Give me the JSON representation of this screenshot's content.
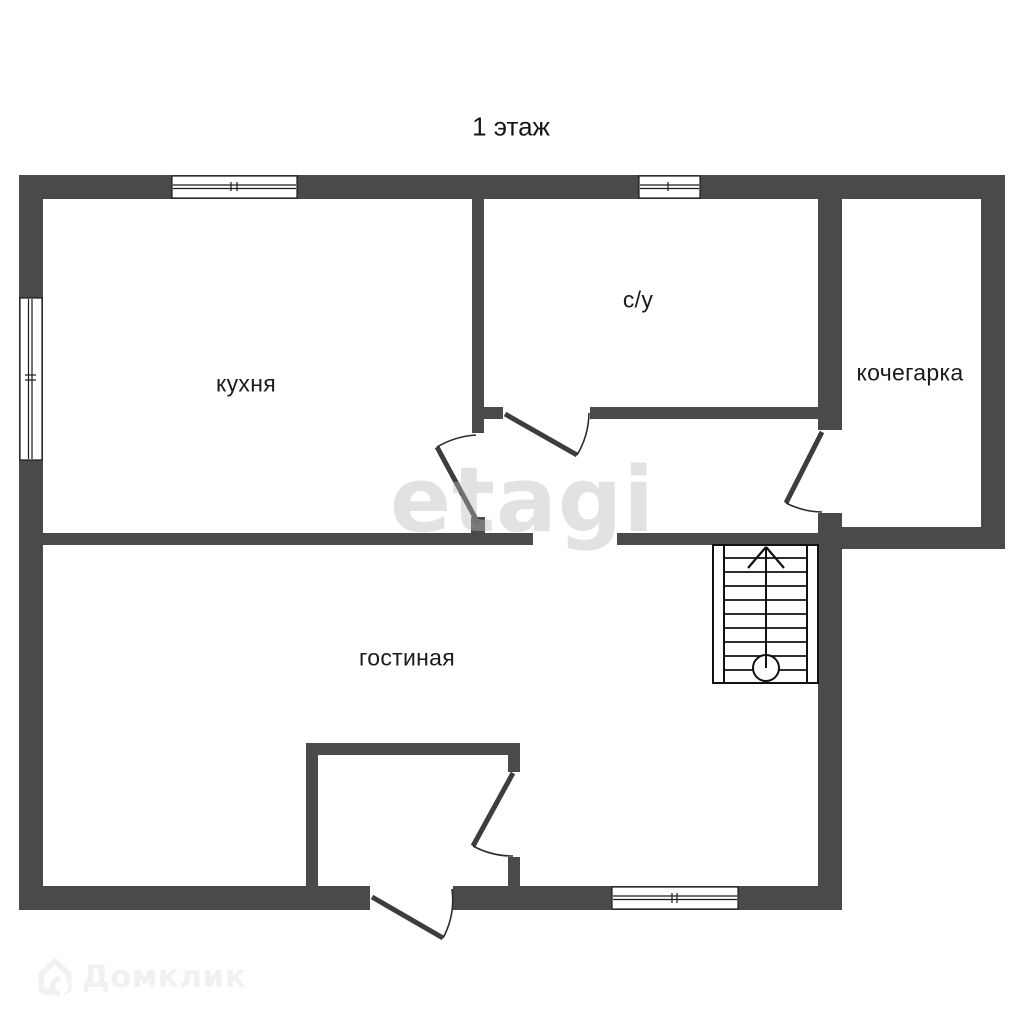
{
  "title": "1 этаж",
  "rooms": [
    {
      "id": "kitchen",
      "label": "кухня"
    },
    {
      "id": "bathroom",
      "label": "с/у"
    },
    {
      "id": "boiler-room",
      "label": "кочегарка"
    },
    {
      "id": "living-room",
      "label": "гостиная"
    }
  ],
  "symbols": {
    "stairs": "stairs-up-symbol",
    "window_count": 4,
    "door_count": 5
  },
  "watermark": {
    "text": "etagi"
  },
  "logo": {
    "icon": "house-icon",
    "text": "Домклик"
  },
  "colors": {
    "wall": "#4a4a4a",
    "line": "#1a1a1a",
    "door_leaf": "#3d3d3d",
    "text": "#1b1b1b",
    "watermark": "#e9e9e9",
    "logo": "#f1f1f1"
  }
}
